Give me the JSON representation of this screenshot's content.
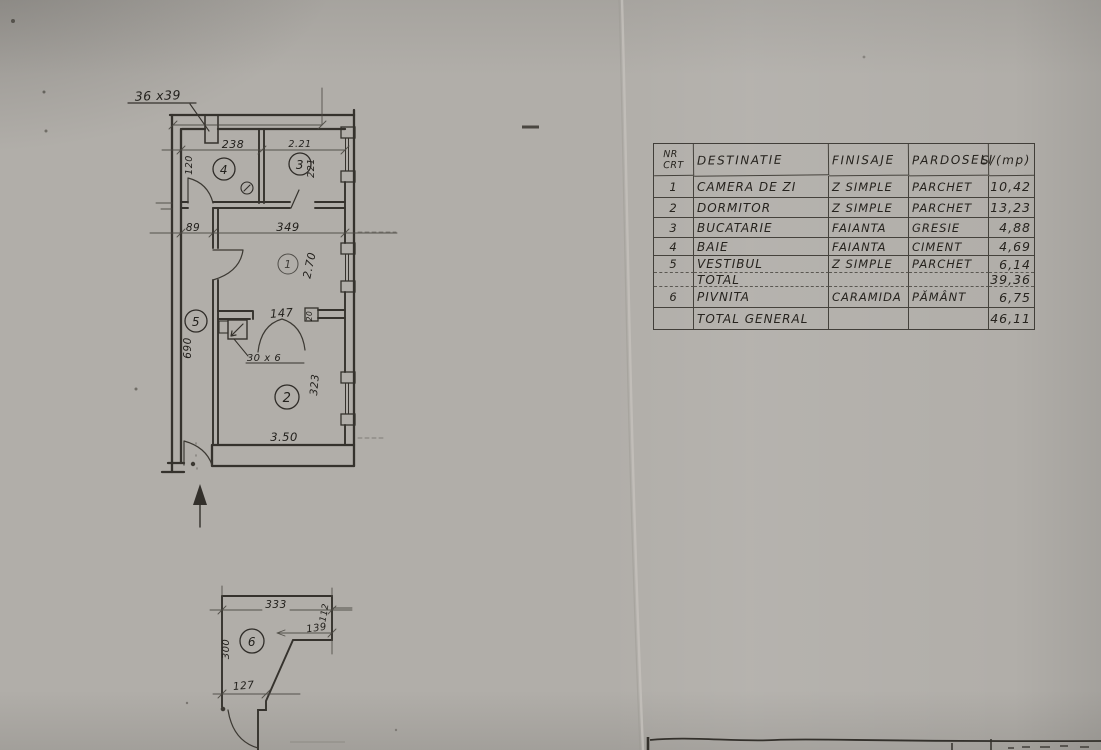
{
  "table": {
    "headers": {
      "nr": "NR\nCRT",
      "destinatie": "DESTINATIE",
      "finisaje": "FINISAJE",
      "pardoseli": "PARDOSELI",
      "s": "S/(mp)"
    },
    "rows": [
      {
        "nr": "1",
        "destinatie": "CAMERA DE ZI",
        "finisaje": "Z SIMPLE",
        "pardoseli": "PARCHET",
        "s": "10,42"
      },
      {
        "nr": "2",
        "destinatie": "DORMITOR",
        "finisaje": "Z SIMPLE",
        "pardoseli": "PARCHET",
        "s": "13,23"
      },
      {
        "nr": "3",
        "destinatie": "BUCATARIE",
        "finisaje": "FAIANTA",
        "pardoseli": "GRESIE",
        "s": "4,88"
      },
      {
        "nr": "4",
        "destinatie": "BAIE",
        "finisaje": "FAIANTA",
        "pardoseli": "CIMENT",
        "s": "4,69"
      },
      {
        "nr": "5",
        "destinatie": "VESTIBUL",
        "finisaje": "Z SIMPLE",
        "pardoseli": "PARCHET",
        "s": "6,14"
      },
      {
        "nr": "",
        "destinatie": "TOTAL",
        "finisaje": "",
        "pardoseli": "",
        "s": "39,36"
      },
      {
        "nr": "6",
        "destinatie": "PIVNITA",
        "finisaje": "CARAMIDA",
        "pardoseli": "PĂMÂNT",
        "s": "6,75"
      },
      {
        "nr": "",
        "destinatie": "TOTAL GENERAL",
        "finisaje": "",
        "pardoseli": "",
        "s": "46,11"
      }
    ]
  },
  "plan": {
    "flue": "36 x39",
    "d238": "238",
    "d221a": "2.21",
    "d221b": "221",
    "d120": "120",
    "d89": "89",
    "d349": "349",
    "d270": "2.70",
    "d147": "147",
    "d30x6": "30 x 6",
    "d20": "20",
    "d690": "690",
    "d323": "323",
    "d350": "3.50",
    "rooms": {
      "r1": "1",
      "r2": "2",
      "r3": "3",
      "r4": "4",
      "r5": "5",
      "r6": "6"
    },
    "cellar": {
      "d333": "333",
      "d112": "112",
      "d139": "139",
      "d300": "300",
      "d127": "127"
    }
  }
}
